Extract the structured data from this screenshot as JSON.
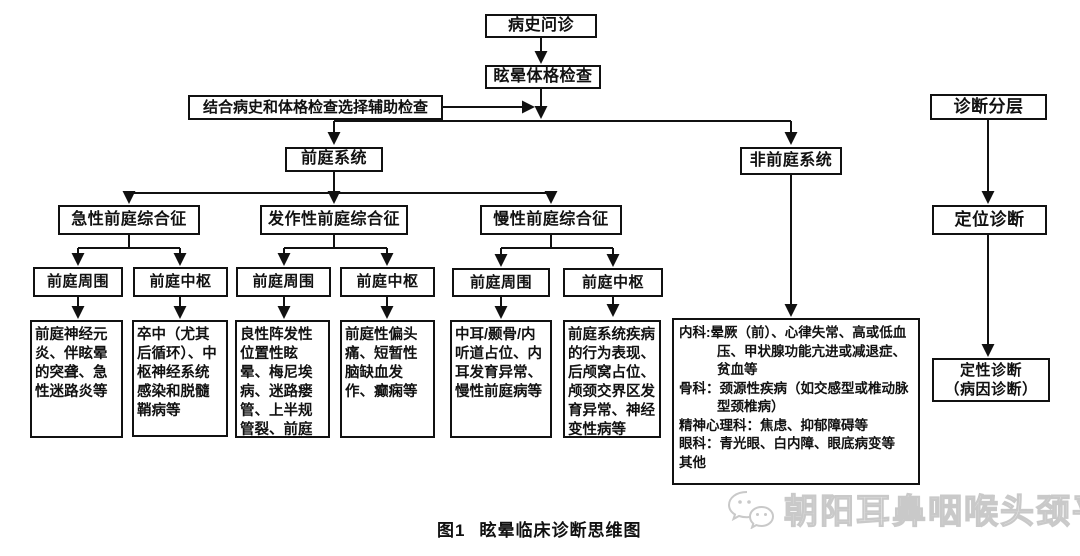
{
  "diagram": {
    "caption": {
      "fig_label": "图1",
      "title": "眩晕临床诊断思维图"
    },
    "watermark": {
      "icon": "wechat-icon",
      "text": "朝阳耳鼻咽喉头颈平台"
    },
    "top_flow": {
      "history": "病史问诊",
      "exam": "眩晕体格检查",
      "aux": "结合病史和体格检查选择辅助检查"
    },
    "branches": {
      "vestibular": "前庭系统",
      "non_vestibular": "非前庭系统"
    },
    "right_flow": {
      "stratification": "诊断分层",
      "localization": "定位诊断",
      "qualitative": "定性诊断",
      "qualitative_sub": "（病因诊断）"
    },
    "syndromes": [
      {
        "label": "急性前庭综合征"
      },
      {
        "label": "发作性前庭综合征"
      },
      {
        "label": "慢性前庭综合征"
      }
    ],
    "level4": [
      {
        "label": "前庭周围"
      },
      {
        "label": "前庭中枢"
      },
      {
        "label": "前庭周围"
      },
      {
        "label": "前庭中枢"
      },
      {
        "label": "前庭周围"
      },
      {
        "label": "前庭中枢"
      }
    ],
    "details": [
      {
        "text": "前庭神经元炎、伴眩晕的突聋、急性迷路炎等"
      },
      {
        "text": "卒中（尤其后循环）、中枢神经系统感染和脱髓鞘病等"
      },
      {
        "text": "良性阵发性位置性眩晕、梅尼埃病、迷路瘘管、上半规管裂、前庭阵发症等"
      },
      {
        "text": "前庭性偏头痛、短暂性脑缺血发作、癫痫等"
      },
      {
        "text": "中耳/颞骨/内听道占位、内耳发育异常、慢性前庭病等"
      },
      {
        "text": "前庭系统疾病的行为表现、后颅窝占位、颅颈交界区发育异常、神经变性病等"
      }
    ],
    "non_vestibular_detail": [
      {
        "label": "内科:",
        "text": "晕厥（前）、心律失常、高或低血压、甲状腺功能亢进或减退症、贫血等"
      },
      {
        "label": "骨科：",
        "text": "颈源性疾病（如交感型或椎动脉型颈椎病）"
      },
      {
        "label": "精神心理科：",
        "text": "焦虑、抑郁障碍等"
      },
      {
        "label": "眼科：",
        "text": "青光眼、白内障、眼底病变等"
      },
      {
        "label": "其他",
        "text": ""
      }
    ],
    "colors": {
      "line": "#111111",
      "box_border": "#111111",
      "text": "#111111",
      "watermark": "#c9c9c9",
      "background": "#ffffff"
    }
  }
}
